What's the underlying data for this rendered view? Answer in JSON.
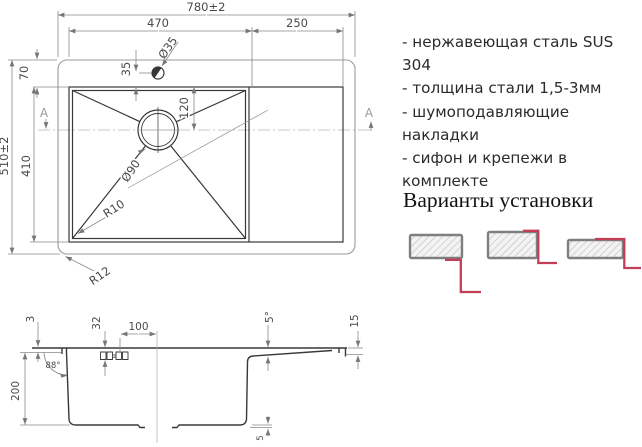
{
  "colors": {
    "accent_red": "#c33f57",
    "drawing_line": "#383838",
    "dimension_line": "#8a8a8a"
  },
  "top_view": {
    "dims": {
      "total_width": "780±2",
      "bowl_width": "470",
      "wing_width": "250",
      "faucet_hole_diameter": "Ø35",
      "faucet_offset": "35",
      "rim_offset": "70",
      "total_depth": "510±2",
      "bowl_depth": "410",
      "drain_offset": "120",
      "drain_diameter": "Ø90",
      "inner_corner_radius": "R10",
      "outer_corner_radius": "R12",
      "section_marker_left": "A",
      "section_marker_right": "A"
    }
  },
  "section_view": {
    "dims": {
      "rim_lip": "3",
      "clip_depth": "32",
      "clip_distance": "100",
      "board_slope": "5°",
      "edge_height": "15",
      "wall_angle": "88°",
      "bowl_depth": "200",
      "bottom_step": "5"
    }
  },
  "specs": {
    "items": [
      "- нержавеющая сталь SUS 304",
      "- толщина стали 1,5-3мм",
      "- шумоподавляющие накладки",
      "- сифон и крепежи в комплекте"
    ]
  },
  "install": {
    "title": "Варианты установки"
  }
}
